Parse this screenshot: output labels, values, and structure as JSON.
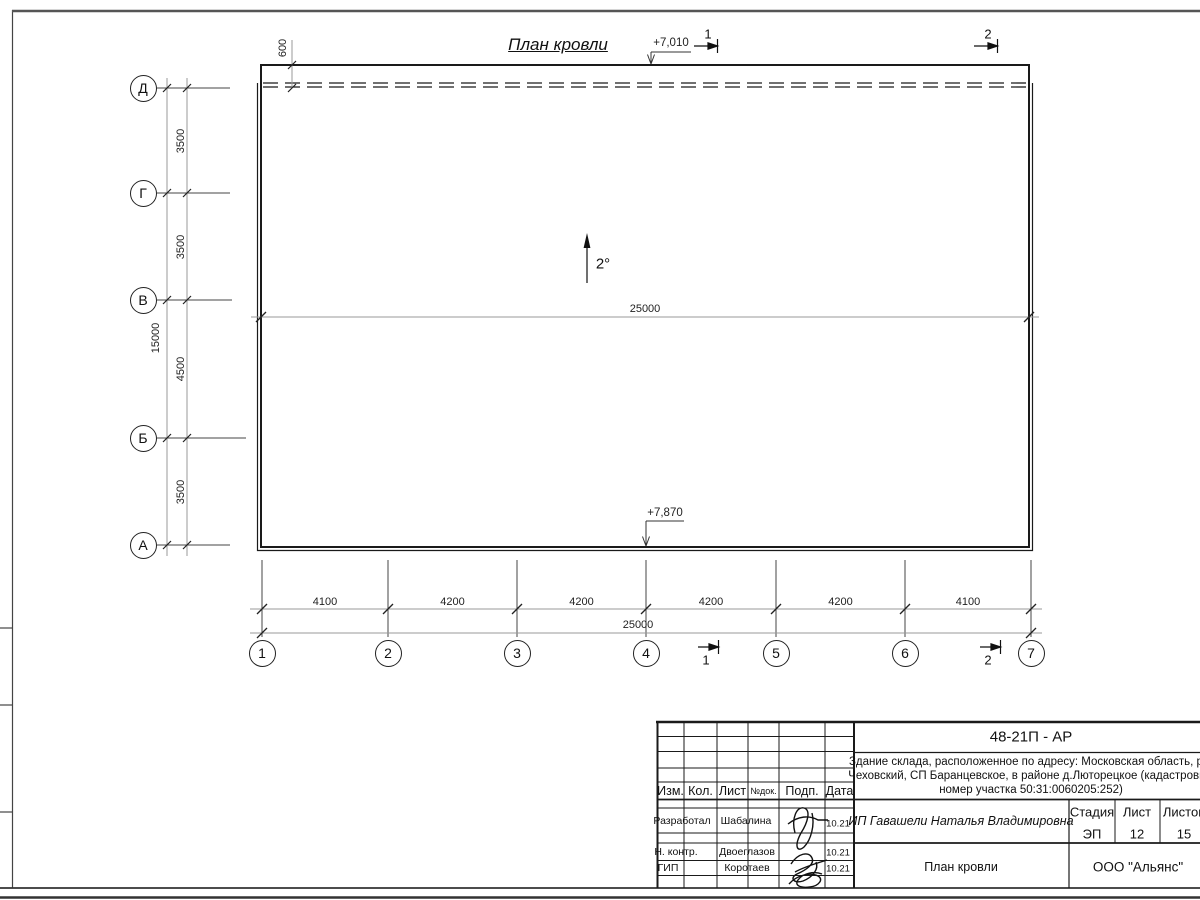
{
  "palette": {
    "line": "#1a1a1a",
    "dim_line": "#999999",
    "background": "#ffffff"
  },
  "drawing": {
    "title": "План кровли",
    "slope": "2°",
    "elevation_top": "+7,010",
    "elevation_bottom": "+7,870",
    "inner_length": "25000",
    "overhang": "600",
    "row_axes": [
      "Д",
      "Г",
      "В",
      "Б",
      "А"
    ],
    "row_dims": [
      "3500",
      "3500",
      "4500",
      "3500"
    ],
    "row_total": "15000",
    "col_axes": [
      "1",
      "2",
      "3",
      "4",
      "5",
      "6",
      "7"
    ],
    "col_dims": [
      "4100",
      "4200",
      "4200",
      "4200",
      "4200",
      "4100"
    ],
    "col_total": "25000",
    "section_marks": [
      "1",
      "2"
    ]
  },
  "title_block": {
    "doc_code": "48-21П - АР",
    "description_lines": [
      "Здание склада, расположенное по адресу: Московская область, р-н",
      "Чеховский, СП Баранцевское, в районе д.Люторецкое  (кадастровый",
      "номер участка 50:31:0060205:252)"
    ],
    "columns": [
      "Изм.",
      "Кол.",
      "Лист",
      "№док.",
      "Подп.",
      "Дата"
    ],
    "sign_rows": [
      {
        "role": "Разработал",
        "name": "Шабалина",
        "date": "10.21"
      },
      {
        "role": "Н. контр.",
        "name": "Двоеглазов",
        "date": "10.21"
      },
      {
        "role": "ГИП",
        "name": "Коротаев",
        "date": "10.21"
      }
    ],
    "client": "ИП Гавашели Наталья Владимировна",
    "stage_label": "Стадия",
    "sheet_label": "Лист",
    "sheets_label": "Листов",
    "stage": "ЭП",
    "sheet": "12",
    "sheets": "15",
    "sheet_title": "План кровли",
    "organization": "ООО \"Альянс\""
  }
}
